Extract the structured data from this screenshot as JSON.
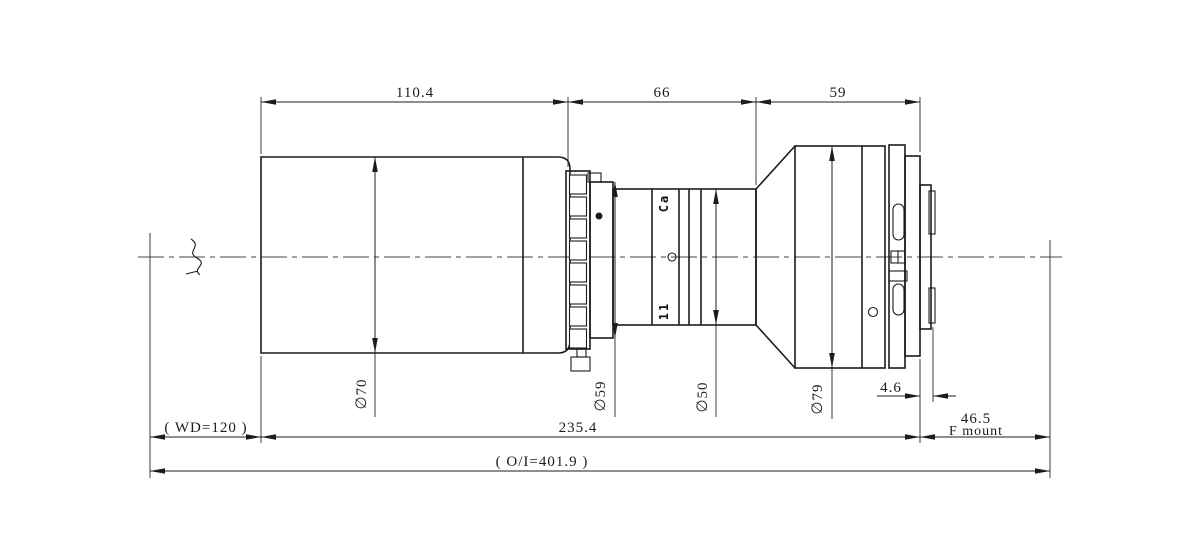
{
  "drawing_title": "lens-outline-technical-drawing",
  "colors": {
    "background": "#ffffff",
    "line": "#1c1c1c"
  },
  "dims_top": {
    "front": "110.4",
    "mid": "66",
    "rear": "59"
  },
  "dims_bottom": {
    "wd": "( WD=120 )",
    "total": "235.4",
    "flange_value": "46.5",
    "flange_label": "F mount",
    "bayonet": "4.6",
    "overall": "( O/I=401.9 )"
  },
  "diameters": {
    "front_barrel": "∅70",
    "clamp_ring": "∅59",
    "mid_barrel": "∅50",
    "rear_barrel": "∅79"
  },
  "markings": {
    "upper": "Ca",
    "lower": "11"
  }
}
